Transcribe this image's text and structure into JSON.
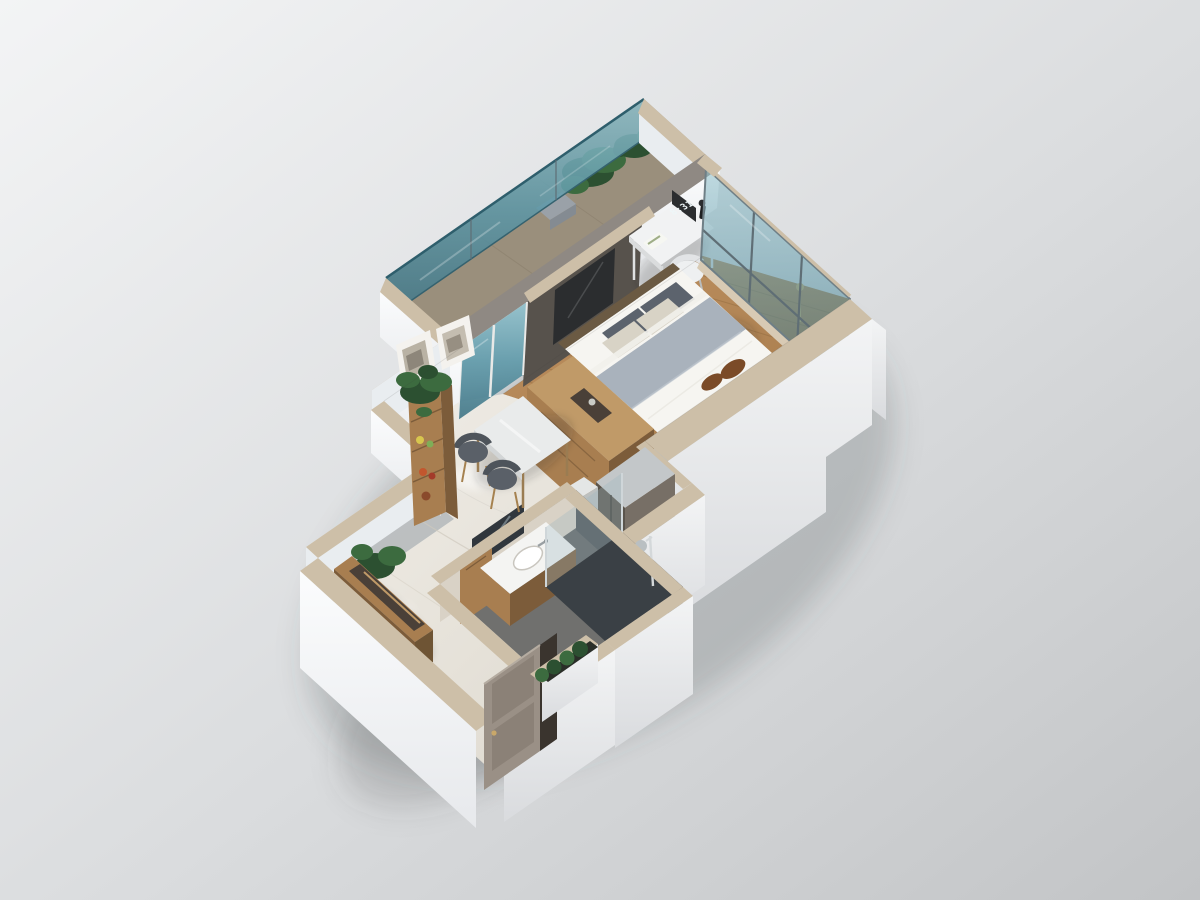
{
  "meta": {
    "title": "3D isometric dollhouse render of a studio apartment floor plan",
    "view": "cutaway axonometric from above",
    "render_style": "photorealistic architectural visualization on plain gray backdrop"
  },
  "clock": {
    "time": "8:31"
  },
  "colors": {
    "bg_light": "#f3f4f5",
    "bg_mid": "#dadcde",
    "bg_dark": "#c2c4c6",
    "wall_top": "#cdbfa8",
    "parapet_gray": "#8f8983",
    "wall_white": "#fbfcfd",
    "wall_shade": "#e4e6e9",
    "wall_cool": "#e9edf0",
    "glass_teal_light": "#8fbfca",
    "glass_teal": "#5d98a8",
    "glass_teal_deep": "#3f7485",
    "mullion": "#5f6e75",
    "wood_floor": "#b4885a",
    "wood_dark": "#8f6a3e",
    "deck": "#9a8f7c",
    "marble_light": "#efece6",
    "marble_dark": "#ddd8cd",
    "media_dark": "#57524c",
    "tv_black": "#2b2d2f",
    "bed_white": "#f6f5f1",
    "throw_gray": "#a9b2bc",
    "pillow_gray": "#5c636d",
    "pillow_tan": "#d8d3c6",
    "accent_brown": "#7b4b28",
    "furn_wood": "#a87e50",
    "furn_wood_dark": "#7c5c3a",
    "furn_wood_light": "#c09a68",
    "chair_gray": "#5a6068",
    "steel": "#c3c7c9",
    "steel_dark": "#5a544c",
    "white_furn": "#f1f2f3",
    "bath_floor": "#70706e",
    "bath_dark": "#3a4045",
    "door_taupe": "#9a9086",
    "plant_green": "#3c6b3f",
    "plant_dark": "#2c5031",
    "gold": "#c9a86a"
  },
  "rooms": [
    {
      "name": "balcony",
      "features": [
        "teal-glass-railing",
        "potted-plants",
        "lounge-cushion"
      ]
    },
    {
      "name": "bedroom",
      "features": [
        "double-bed",
        "headboard-pillows",
        "gray-throw",
        "brown-accent-pillows",
        "desk",
        "desk-clock",
        "desk-chair",
        "media-wall-tv",
        "glass-curtain-wall",
        "wood-floor",
        "gold-floor-lamp"
      ]
    },
    {
      "name": "living-dining",
      "features": [
        "dining-table",
        "two-gray-chairs",
        "minibar-cabinet",
        "trash-bin",
        "wardrobe-cabinet",
        "tall-fruit-shelf",
        "picture-frames",
        "monstera-plant",
        "marble-floor"
      ]
    },
    {
      "name": "bathroom",
      "features": [
        "vanity-sink",
        "mirror",
        "wood-door",
        "walk-in-shower",
        "shower-column",
        "glass-partition"
      ]
    },
    {
      "name": "entry",
      "features": [
        "console-bench",
        "monstera-plant",
        "entry-door",
        "planter-box-green-bushes"
      ]
    }
  ]
}
